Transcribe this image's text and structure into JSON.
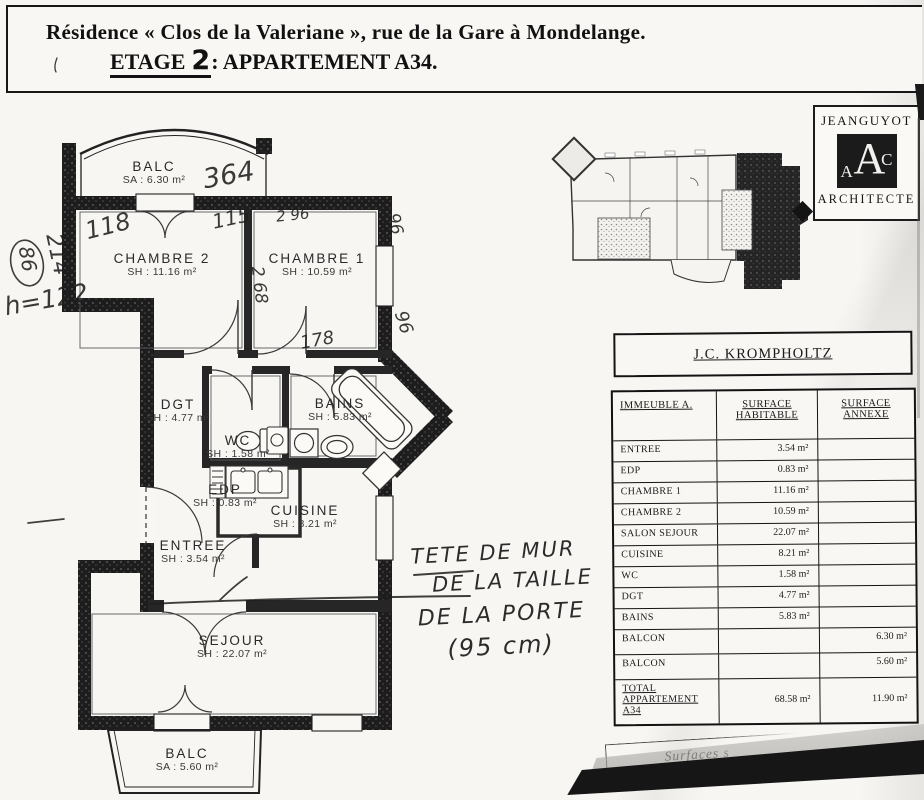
{
  "title": {
    "line1": "Résidence « Clos de la Valeriane », rue de la Gare à Mondelange.",
    "etage_label": "ETAGE",
    "floor_number": "2",
    "line2_rest": ": APPARTEMENT A34."
  },
  "architect_stamp": {
    "name": "JEANGUYOT",
    "monogram_left": "A",
    "monogram_center": "A",
    "monogram_right": "C",
    "title": "ARCHITECTE"
  },
  "plan": {
    "rooms": [
      {
        "name": "BALC",
        "area": "SA : 6.30 m²"
      },
      {
        "name": "CHAMBRE 2",
        "area": "SH : 11.16 m²"
      },
      {
        "name": "CHAMBRE 1",
        "area": "SH : 10.59 m²"
      },
      {
        "name": "DGT",
        "area": "SH : 4.77 m²"
      },
      {
        "name": "WC",
        "area": "SH : 1.58 m²"
      },
      {
        "name": "BAINS",
        "area": "SH : 5.83 m²"
      },
      {
        "name": "EDP",
        "area": "SH : 0.83 m²"
      },
      {
        "name": "CUISINE",
        "area": "SH : 8.21 m²"
      },
      {
        "name": "ENTREE",
        "area": "SH : 3.54 m²"
      },
      {
        "name": "SEJOUR",
        "area": "SH : 22.07 m²"
      },
      {
        "name": "BALC",
        "area": "SA : 5.60 m²"
      }
    ],
    "handwritten_measurements": [
      "364",
      "118",
      "115",
      "2 96",
      "2 68",
      "96",
      "96",
      "178",
      "86",
      "214",
      "h=122"
    ],
    "handwritten_note": [
      "TETE DE MUR",
      "DE LA TAILLE",
      "DE LA PORTE",
      "(95 cm)"
    ]
  },
  "surface_table": {
    "owner": "J.C. KROMPHOLTZ",
    "columns": [
      "IMMEUBLE A.",
      "SURFACE HABITABLE",
      "SURFACE ANNEXE"
    ],
    "rows": [
      {
        "label": "ENTREE",
        "habitable": "3.54 m²",
        "annexe": ""
      },
      {
        "label": "EDP",
        "habitable": "0.83 m²",
        "annexe": ""
      },
      {
        "label": "CHAMBRE 1",
        "habitable": "11.16 m²",
        "annexe": ""
      },
      {
        "label": "CHAMBRE 2",
        "habitable": "10.59 m²",
        "annexe": ""
      },
      {
        "label": "SALON SEJOUR",
        "habitable": "22.07 m²",
        "annexe": ""
      },
      {
        "label": "CUISINE",
        "habitable": "8.21 m²",
        "annexe": ""
      },
      {
        "label": "WC",
        "habitable": "1.58 m²",
        "annexe": ""
      },
      {
        "label": "DGT",
        "habitable": "4.77 m²",
        "annexe": ""
      },
      {
        "label": "BAINS",
        "habitable": "5.83 m²",
        "annexe": ""
      },
      {
        "label": "BALCON",
        "habitable": "",
        "annexe": "6.30 m²"
      },
      {
        "label": "BALCON",
        "habitable": "",
        "annexe": "5.60 m²"
      },
      {
        "label": "TOTAL APPARTEMENT A34",
        "habitable": "68.58 m²",
        "annexe": "11.90 m²"
      }
    ]
  },
  "footer": {
    "fragment": "Surfaces s"
  }
}
